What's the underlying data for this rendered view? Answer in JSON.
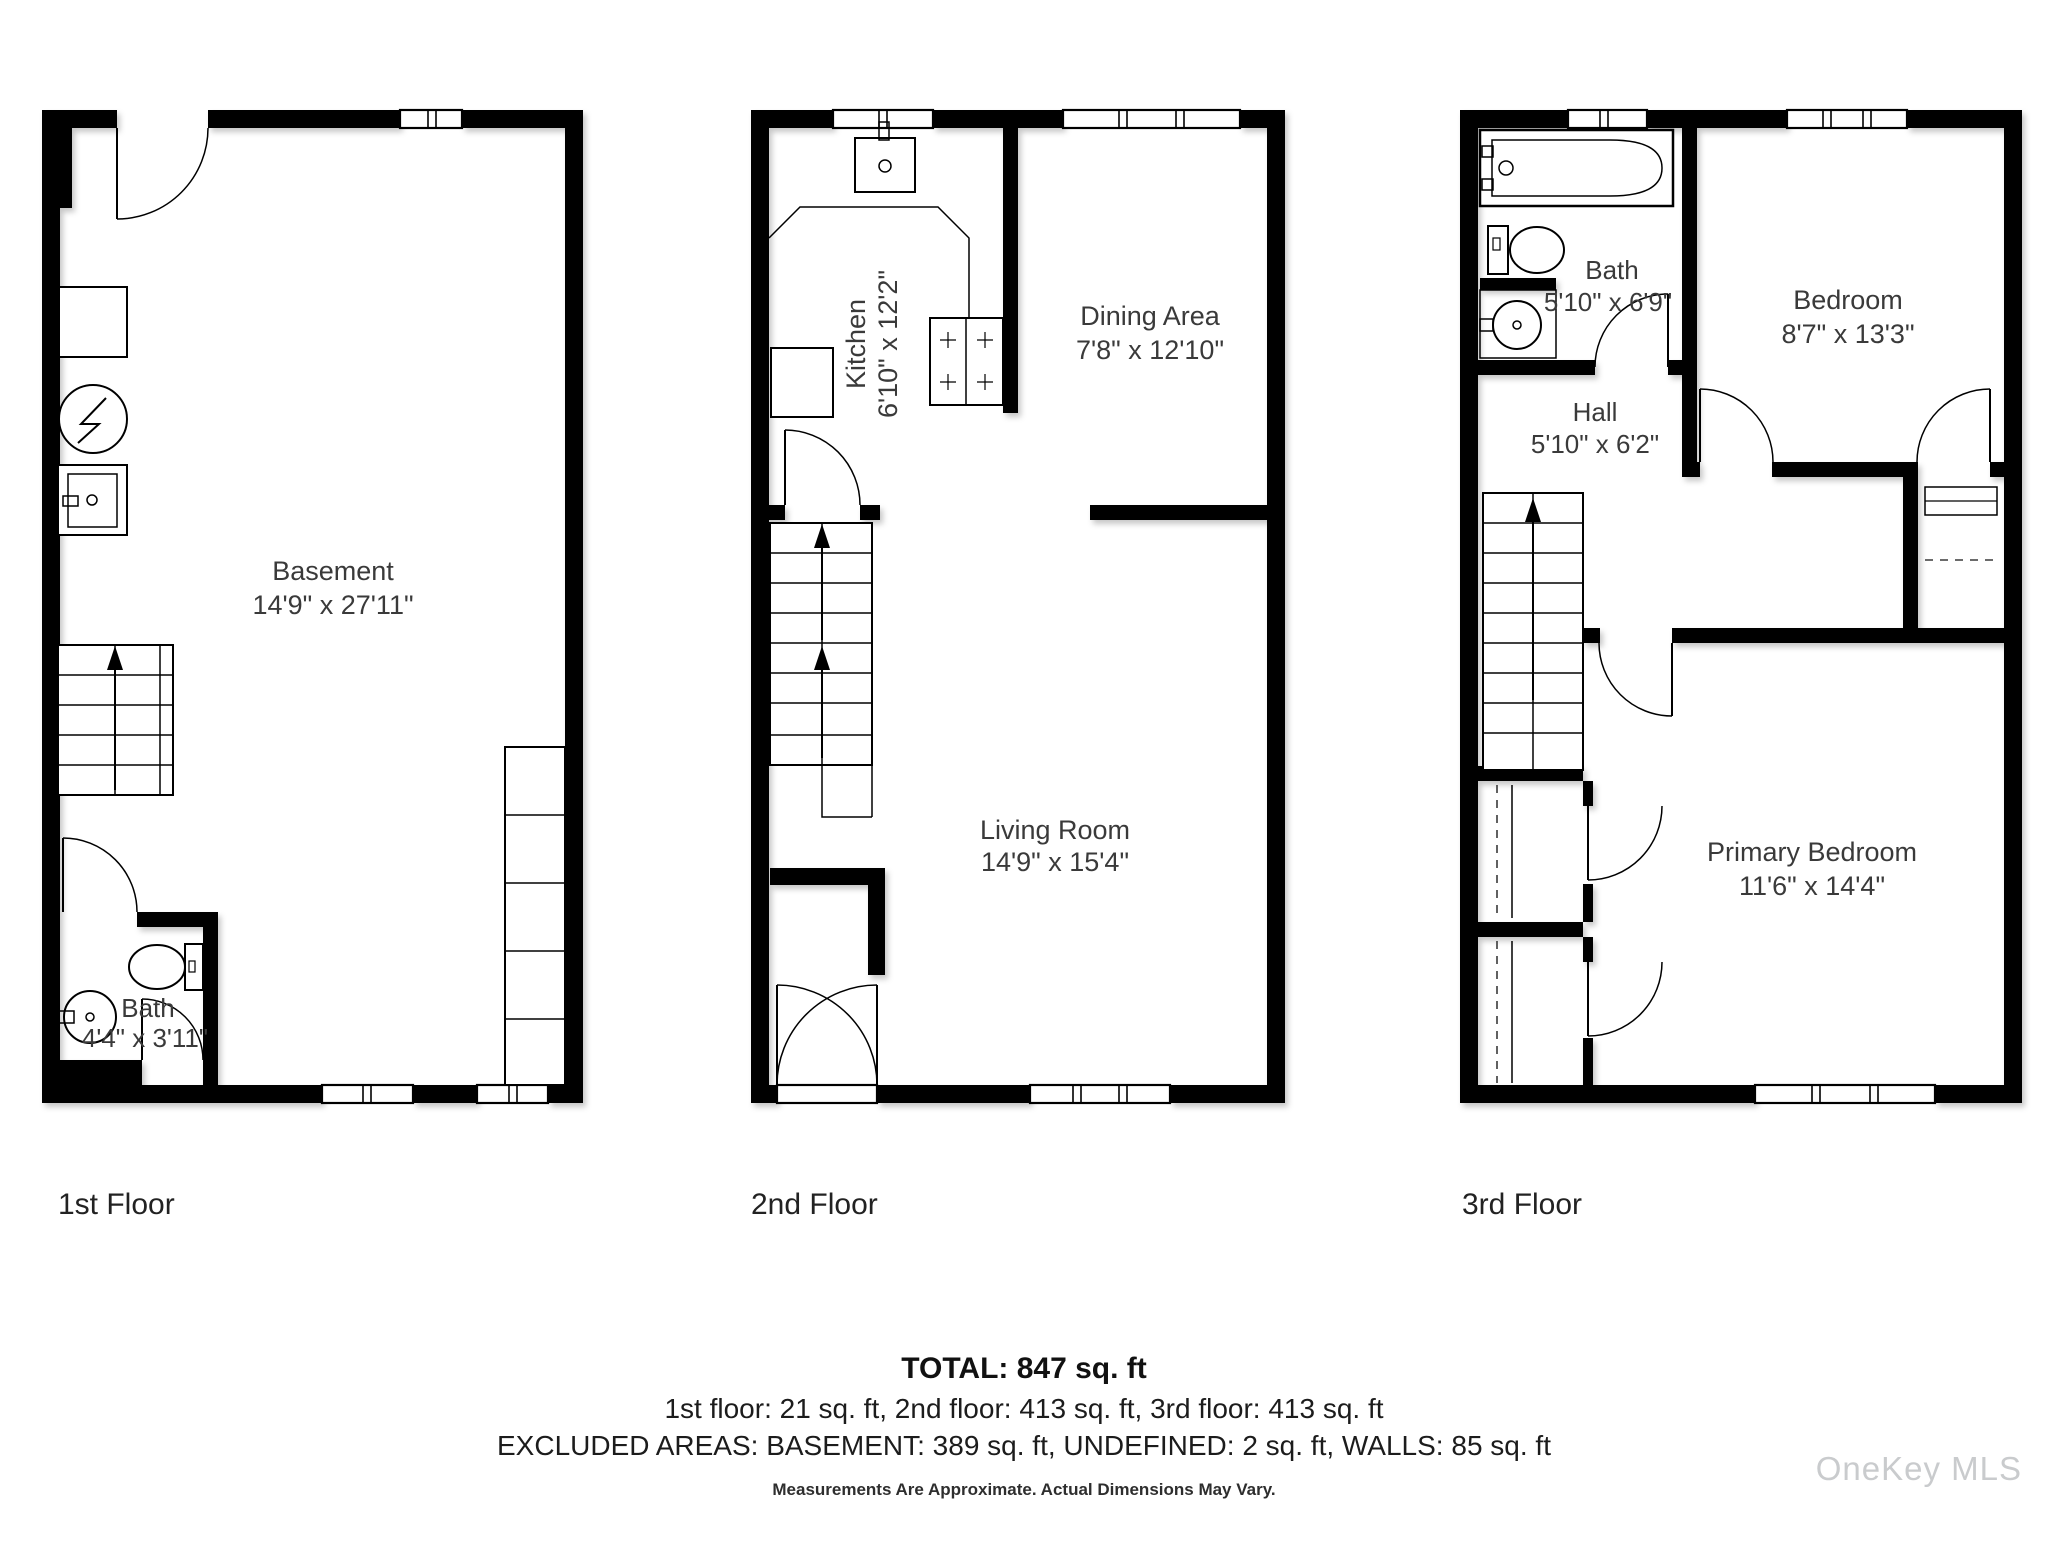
{
  "floors": [
    {
      "caption": "1st Floor",
      "rooms": [
        {
          "name": "Basement",
          "dims": "14'9\" x 27'11\""
        },
        {
          "name": "Bath",
          "dims": "4'4\" x 3'11\""
        }
      ]
    },
    {
      "caption": "2nd Floor",
      "rooms": [
        {
          "name": "Kitchen",
          "dims": "6'10\" x 12'2\""
        },
        {
          "name": "Dining Area",
          "dims": "7'8\" x 12'10\""
        },
        {
          "name": "Living Room",
          "dims": "14'9\" x 15'4\""
        }
      ]
    },
    {
      "caption": "3rd Floor",
      "rooms": [
        {
          "name": "Bath",
          "dims": "5'10\" x 6'9\""
        },
        {
          "name": "Hall",
          "dims": "5'10\" x 6'2\""
        },
        {
          "name": "Bedroom",
          "dims": "8'7\" x 13'3\""
        },
        {
          "name": "Primary Bedroom",
          "dims": "11'6\" x 14'4\""
        }
      ]
    }
  ],
  "footer": {
    "total": "TOTAL: 847 sq. ft",
    "floors_line": "1st floor: 21 sq. ft, 2nd floor: 413 sq. ft, 3rd floor: 413 sq. ft",
    "excluded_line": "EXCLUDED AREAS: BASEMENT: 389 sq. ft, UNDEFINED: 2 sq. ft, WALLS: 85 sq. ft",
    "disclaimer": "Measurements Are Approximate. Actual Dimensions May Vary."
  },
  "watermark": "OneKey MLS",
  "colors": {
    "wall": "#000000",
    "room_label": "#3a3a3a",
    "caption": "#222222",
    "watermark": "#c9cbcd"
  }
}
